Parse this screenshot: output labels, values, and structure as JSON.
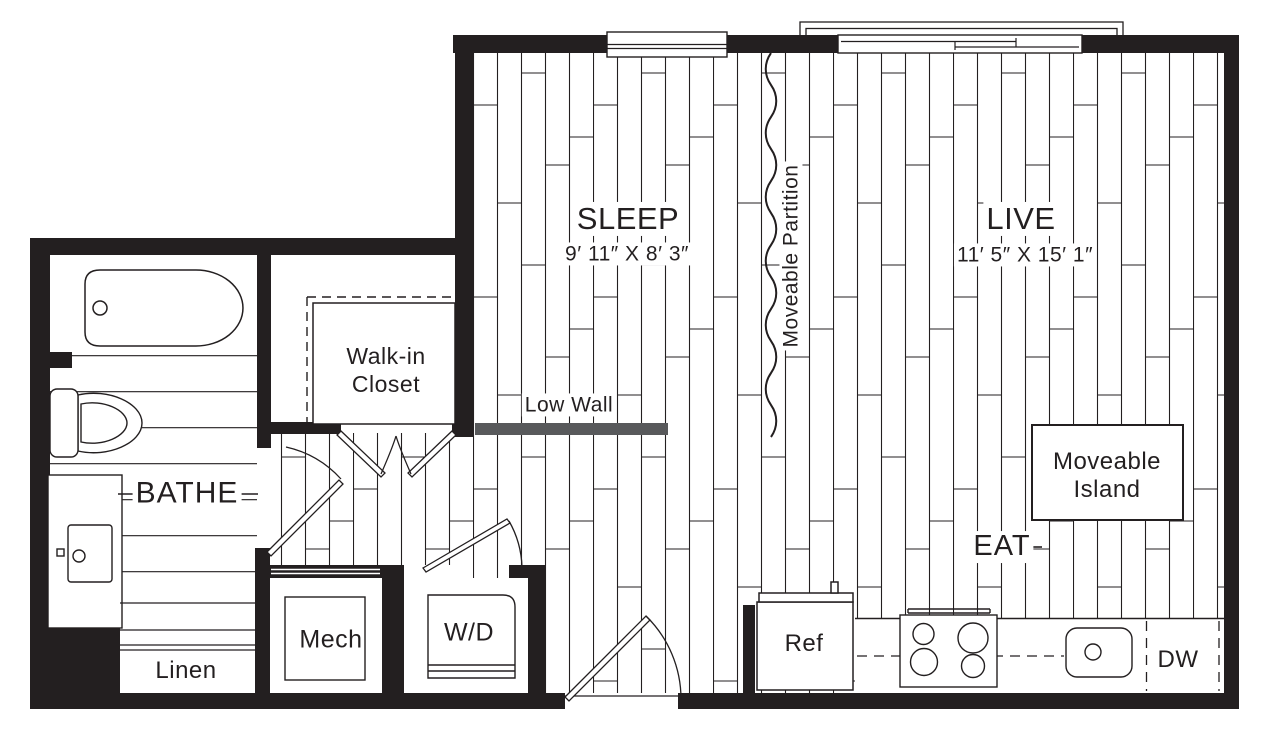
{
  "plan": {
    "rooms": {
      "sleep": {
        "label": "SLEEP",
        "dimensions": "9′ 11″ X 8′ 3″"
      },
      "live": {
        "label": "LIVE",
        "dimensions": "11′ 5″ X 15′ 1″"
      },
      "bathe": {
        "label": "BATHE"
      },
      "eat": {
        "label": "EAT"
      },
      "walk_in_closet": {
        "line1": "Walk-in",
        "line2": "Closet"
      },
      "mech": {
        "label": "Mech"
      },
      "laundry": {
        "label": "W/D"
      },
      "linen": {
        "label": "Linen"
      }
    },
    "features": {
      "low_wall": {
        "label": "Low Wall"
      },
      "moveable_partition": {
        "label": "Moveable Partition"
      },
      "moveable_island": {
        "line1": "Moveable",
        "line2": "Island"
      },
      "refrigerator": {
        "label": "Ref"
      },
      "dishwasher": {
        "label": "DW"
      }
    },
    "colors": {
      "line": "#231f20",
      "low_wall_gray": "#58595b",
      "background": "#ffffff"
    }
  }
}
